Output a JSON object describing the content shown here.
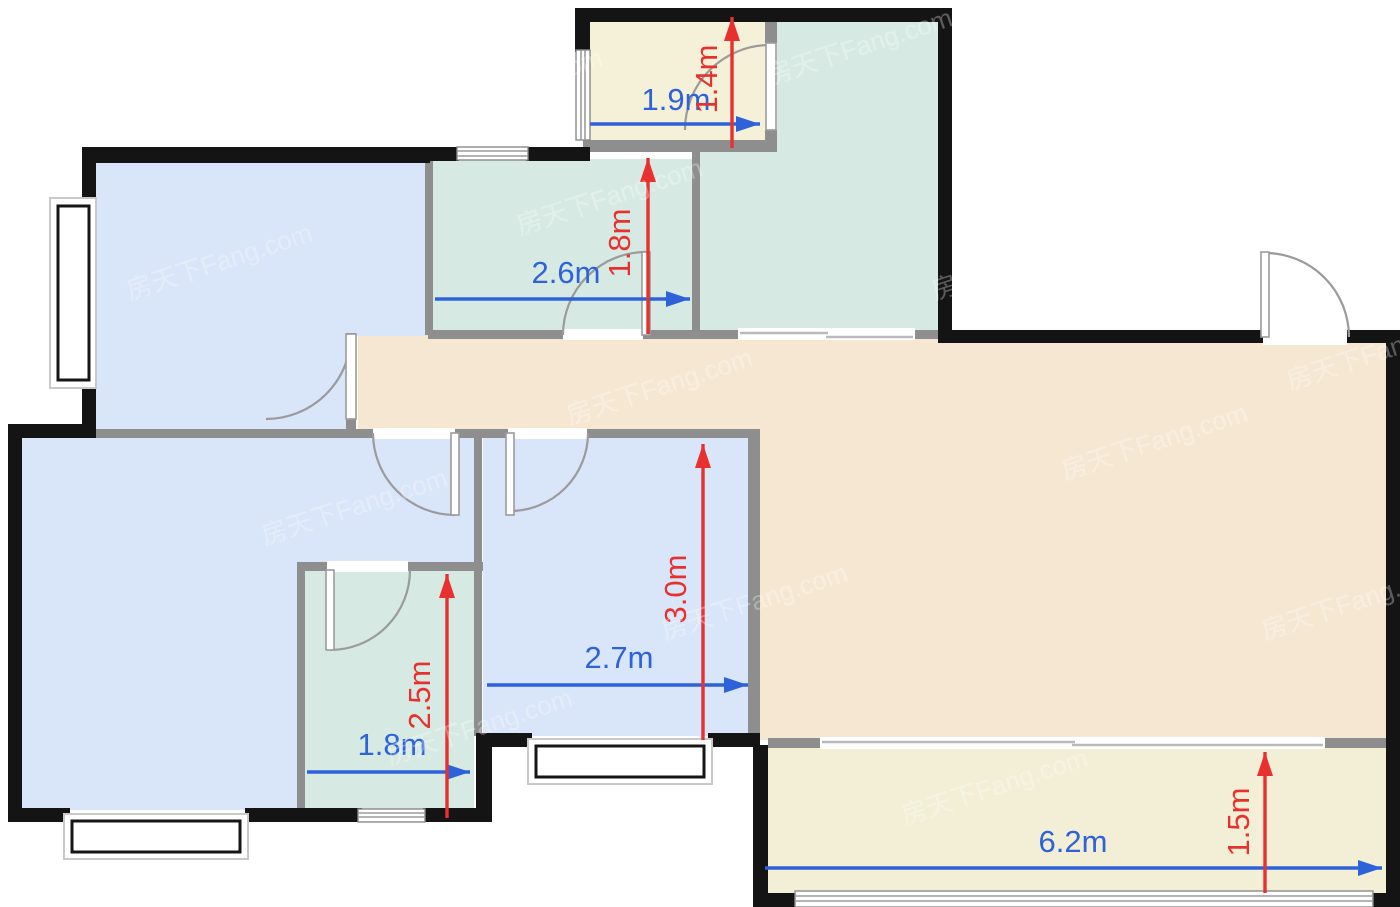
{
  "watermark": {
    "text": "房天下Fang.com"
  },
  "colors": {
    "wall": "#141414",
    "innerWall": "#8e8e8e",
    "bedroom": "#d9e5f8",
    "kitchen": "#d6eae3",
    "living": "#f6e7d3",
    "balcony": "#f2efd6",
    "storage": "#f4f1d8",
    "dimBlue": "#2e62d9",
    "dimRed": "#e8312e"
  },
  "dimensions": [
    {
      "name": "storage-width",
      "value": "1.9m",
      "axis": "h",
      "x1": 590,
      "y1": 124,
      "x2": 760,
      "y2": 124,
      "lx": 676,
      "ly": 110
    },
    {
      "name": "storage-depth",
      "value": "1.4m",
      "axis": "v",
      "x1": 732,
      "y1": 148,
      "x2": 732,
      "y2": 17,
      "lx": 717,
      "ly": 79
    },
    {
      "name": "kitchen-width",
      "value": "2.6m",
      "axis": "h",
      "x1": 435,
      "y1": 299,
      "x2": 690,
      "y2": 299,
      "lx": 566,
      "ly": 283
    },
    {
      "name": "kitchen-depth",
      "value": "1.8m",
      "axis": "v",
      "x1": 648,
      "y1": 334,
      "x2": 648,
      "y2": 158,
      "lx": 630,
      "ly": 243
    },
    {
      "name": "bedroom-width",
      "value": "2.7m",
      "axis": "h",
      "x1": 487,
      "y1": 685,
      "x2": 748,
      "y2": 685,
      "lx": 619,
      "ly": 668
    },
    {
      "name": "bedroom-depth",
      "value": "3.0m",
      "axis": "v",
      "x1": 703,
      "y1": 740,
      "x2": 703,
      "y2": 444,
      "lx": 686,
      "ly": 589
    },
    {
      "name": "bathroom-width",
      "value": "1.8m",
      "axis": "h",
      "x1": 307,
      "y1": 772,
      "x2": 470,
      "y2": 772,
      "lx": 392,
      "ly": 755
    },
    {
      "name": "bathroom-depth",
      "value": "2.5m",
      "axis": "v",
      "x1": 447,
      "y1": 818,
      "x2": 447,
      "y2": 574,
      "lx": 430,
      "ly": 695
    },
    {
      "name": "balcony-width",
      "value": "6.2m",
      "axis": "h",
      "x1": 765,
      "y1": 868,
      "x2": 1382,
      "y2": 868,
      "lx": 1073,
      "ly": 852
    },
    {
      "name": "balcony-depth",
      "value": "1.5m",
      "axis": "v",
      "x1": 1265,
      "y1": 893,
      "x2": 1265,
      "y2": 752,
      "lx": 1249,
      "ly": 822
    }
  ]
}
